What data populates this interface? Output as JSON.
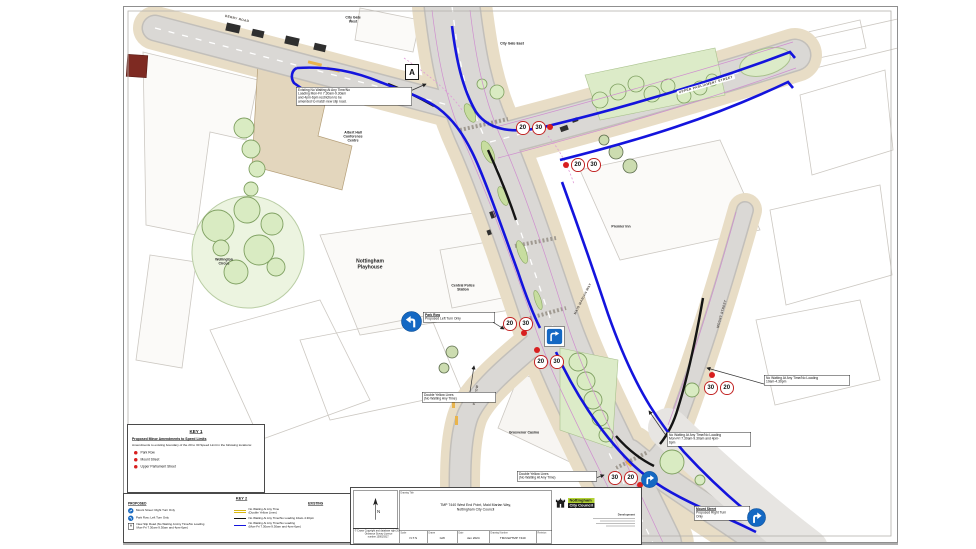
{
  "map": {
    "colors": {
      "restriction_blue": "#1414dd",
      "restriction_black": "#141414",
      "badge_ring_red": "#c22424",
      "marker_dot_red": "#d81f1f",
      "sign_blue": "#1468c3",
      "road_grey": "#d8d6d3",
      "footway_tan": "#e8ddc6",
      "tree_green": "#d9ebc2",
      "logo_green": "#b2d235"
    },
    "labels": [
      {
        "text": "DERBY ROAD",
        "x": 237,
        "y": 19,
        "rot": 13,
        "style": "road"
      },
      {
        "text": "City Gate\nWest",
        "x": 353,
        "y": 20,
        "rot": 0,
        "style": "place"
      },
      {
        "text": "City Gate East",
        "x": 512,
        "y": 44,
        "rot": 0,
        "style": "place"
      },
      {
        "text": "UPPER PARLIAMENT STREET",
        "x": 706,
        "y": 85,
        "rot": -16,
        "style": "road-pill"
      },
      {
        "text": "Albert Hall\nConference\nCentre",
        "x": 353,
        "y": 137,
        "rot": 0,
        "style": "place"
      },
      {
        "text": "Wellington\nCircus",
        "x": 224,
        "y": 262,
        "rot": 0,
        "style": "place"
      },
      {
        "text": "Nottingham\nPlayhouse",
        "x": 370,
        "y": 264,
        "rot": 0,
        "style": "place-lg"
      },
      {
        "text": "Central Police\nStation",
        "x": 463,
        "y": 288,
        "rot": 0,
        "style": "place"
      },
      {
        "text": "Premier Inn",
        "x": 621,
        "y": 227,
        "rot": 0,
        "style": "place"
      },
      {
        "text": "Grosvenor Casino",
        "x": 524,
        "y": 433,
        "rot": 0,
        "style": "place"
      },
      {
        "text": "PARK ROW",
        "x": 476,
        "y": 395,
        "rot": -80,
        "style": "road"
      },
      {
        "text": "MAID MARIAN WAY",
        "x": 583,
        "y": 299,
        "rot": -63,
        "style": "road"
      },
      {
        "text": "MOUNT STREET",
        "x": 722,
        "y": 314,
        "rot": -74,
        "style": "road"
      },
      {
        "text": "MOUNT STREET",
        "x": 627,
        "y": 529,
        "rot": -56,
        "style": "road"
      }
    ],
    "callouts": [
      {
        "name": "existing-restriction-note",
        "x": 296,
        "y": 87,
        "w": 112,
        "lines": [
          "Existing No Waiting At Any Time/No",
          "Loading Mon-Fri 7.30am-9.30am",
          "and 4pm-6pm restriction to be",
          "amended to match new slip road."
        ],
        "leader": [
          408,
          92,
          426,
          84
        ]
      },
      {
        "name": "park-row-proposal",
        "x": 423,
        "y": 312,
        "w": 68,
        "title": "Park Row",
        "lines": [
          "Proposed Left Turn Only"
        ],
        "icon": "left-turn",
        "icon_x": 401,
        "icon_y": 311,
        "icon_size": 21,
        "leader": [
          491,
          321,
          504,
          329
        ]
      },
      {
        "name": "double-yellow-note-park-row",
        "x": 422,
        "y": 392,
        "w": 70,
        "lines": [
          "Double Yellow Lines",
          "(No Waiting Any Time)"
        ],
        "leader": [
          470,
          392,
          474,
          366
        ]
      },
      {
        "name": "double-yellow-note-south",
        "x": 517,
        "y": 471,
        "w": 76,
        "lines": [
          "Double Yellow Lines",
          "(No Waiting At Any Time)"
        ],
        "leader": [
          593,
          479,
          604,
          475
        ]
      },
      {
        "name": "no-waiting-10am-note",
        "x": 764,
        "y": 375,
        "w": 82,
        "lines": [
          "No Waiting At Any Time/No Loading",
          "10am-4.30pm"
        ],
        "leader": [
          764,
          384,
          707,
          368
        ]
      },
      {
        "name": "no-waiting-monfri-note",
        "x": 667,
        "y": 432,
        "w": 80,
        "lines": [
          "No Waiting At Any Time/No Loading",
          "Mon-Fri 7.30am-9.30am and 4pm-",
          "6pm"
        ],
        "leader": [
          667,
          437,
          649,
          411
        ]
      },
      {
        "name": "mount-street-proposal",
        "x": 694,
        "y": 506,
        "w": 52,
        "title": "Mount Street",
        "lines": [
          "Proposed Right Turn",
          "Only"
        ],
        "icon": "right-turn",
        "icon_x": 747,
        "icon_y": 508,
        "icon_size": 19
      }
    ],
    "speed_groups": [
      {
        "x": 516,
        "y": 121,
        "values": [
          "20",
          "30"
        ],
        "dot": [
          550,
          127
        ]
      },
      {
        "x": 571,
        "y": 158,
        "values": [
          "20",
          "30"
        ],
        "dot": [
          566,
          165
        ]
      },
      {
        "x": 503,
        "y": 317,
        "values": [
          "20",
          "30"
        ],
        "dot": [
          524,
          333
        ]
      },
      {
        "x": 534,
        "y": 355,
        "values": [
          "20",
          "30"
        ],
        "dot": [
          537,
          350
        ]
      },
      {
        "x": 608,
        "y": 471,
        "values": [
          "30",
          "20"
        ],
        "dot": [
          640,
          485
        ]
      },
      {
        "x": 704,
        "y": 381,
        "values": [
          "30",
          "20"
        ],
        "dot": [
          712,
          375
        ]
      }
    ],
    "signs": [
      {
        "type": "slip-merge",
        "x": 544,
        "y": 326,
        "size": 17,
        "boxed": true
      },
      {
        "type": "right-turn",
        "x": 641,
        "y": 471,
        "size": 17,
        "boxed": false
      }
    ],
    "marker_a": {
      "label": "A",
      "x": 405,
      "y": 64
    }
  },
  "key1": {
    "title": "KEY 1",
    "heading": "Proposed Minor Amendments to Speed Limits",
    "description": "Amendments to existing boundary of the 20 to 30 Speed Limit in the following locations:",
    "items": [
      "Park Row",
      "Mount Street",
      "Upper Parliament Street"
    ]
  },
  "key2": {
    "title": "KEY 2",
    "proposed_header": "PROPOSED",
    "existing_header": "EXISTING",
    "proposed": [
      {
        "icon": "right-turn",
        "label": "Mount Street: Right Turn Only"
      },
      {
        "icon": "left-turn",
        "label": "Park Row: Left Turn Only"
      },
      {
        "icon": "a-box",
        "label": "New Slip Road (No Waiting At Any Time/No Loading\nMon-Fri 7.30am-9.30am and 4pm-6pm)"
      }
    ],
    "existing": [
      {
        "symbol": "double-yellow",
        "label": "No Waiting At Any Time\n(Double Yellow Lines)"
      },
      {
        "symbol": "black-line",
        "label": "No Waiting At Any Time/No Loading 10am-4.30pm"
      },
      {
        "symbol": "blue-line",
        "label": "No Waiting At Any Time/No Loading\n(Mon-Fri 7.30am-9.30am and 4pm-6pm)"
      }
    ]
  },
  "drawing": {
    "title_label": "Drawing Title",
    "title1": "TMP 7440 West End Point, Maid Marian Way,",
    "title2": "Nottingham City Council",
    "north_letter": "N",
    "fields": [
      {
        "label": "Scale",
        "value": "N.T.S"
      },
      {
        "label": "Drawn",
        "value": "GW"
      },
      {
        "label": "Date",
        "value": "Jan 2024"
      },
      {
        "label": "Drawing Number",
        "value": "TM/GW/TMP 7440"
      },
      {
        "label": "Revision",
        "value": ""
      }
    ],
    "copyright_lines": [
      "© Crown Copyright and database right 2024.",
      "Ordnance Survey Licence",
      "number 100019317."
    ],
    "logo": {
      "org1": "Nottingham",
      "org2": "City Council",
      "dept": "Development"
    }
  }
}
